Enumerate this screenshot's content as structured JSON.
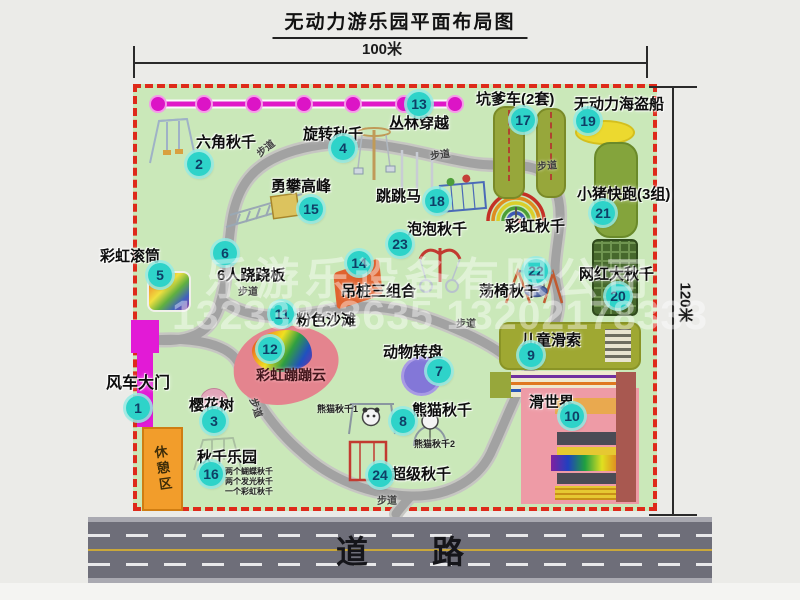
{
  "title": "无动力游乐园平面布局图",
  "dimensions": {
    "width_label": "100米",
    "height_label": "120米"
  },
  "road": {
    "label": "道路"
  },
  "rest_area": {
    "label": "休憩区"
  },
  "path_label": "步道",
  "watermark": {
    "company": "乐游乐设备有限公司",
    "phone": "13233863635 13202178333"
  },
  "unnumbered": {
    "rainbow_swing": "彩虹秋千"
  },
  "colors": {
    "border_red": "#de2a1a",
    "park_green": "#cae8b9",
    "marker_teal": "#2ed3c9",
    "gate_magenta": "#e21ad6",
    "chain_magenta": "#e018c8",
    "rest_orange": "#f29d2b",
    "road_gray": "#6e6e79"
  },
  "attractions": [
    {
      "num": "1",
      "label": "风车大门"
    },
    {
      "num": "2",
      "label": "六角秋千"
    },
    {
      "num": "3",
      "label": "樱花树"
    },
    {
      "num": "4",
      "label": "旋转秋千"
    },
    {
      "num": "5",
      "label": "彩虹滚筒"
    },
    {
      "num": "6",
      "label": "6人跷跷板"
    },
    {
      "num": "7",
      "label": "动物转盘"
    },
    {
      "num": "8",
      "label": "熊猫秋千",
      "notes": [
        "熊猫秋千1",
        "熊猫秋千2"
      ]
    },
    {
      "num": "9",
      "label": "儿童滑索"
    },
    {
      "num": "10",
      "label": "滑世界"
    },
    {
      "num": "11",
      "label": "粉色沙滩"
    },
    {
      "num": "12",
      "label": "彩虹蹦蹦云"
    },
    {
      "num": "13",
      "label": "丛林穿越"
    },
    {
      "num": "14",
      "label": "吊桩三组合"
    },
    {
      "num": "15",
      "label": "勇攀高峰"
    },
    {
      "num": "16",
      "label": "秋千乐园",
      "notes": [
        "两个蝴蝶秋千",
        "两个发光秋千",
        "一个彩虹秋千"
      ]
    },
    {
      "num": "17",
      "label": "坑爹车(2套)"
    },
    {
      "num": "18",
      "label": "跳跳马"
    },
    {
      "num": "19",
      "label": "无动力海盗船"
    },
    {
      "num": "20",
      "label": "网红大秋千"
    },
    {
      "num": "21",
      "label": "小猪快跑(3组)"
    },
    {
      "num": "22",
      "label": "荡椅秋千"
    },
    {
      "num": "23",
      "label": "泡泡秋千"
    },
    {
      "num": "24",
      "label": "超级秋千"
    }
  ]
}
